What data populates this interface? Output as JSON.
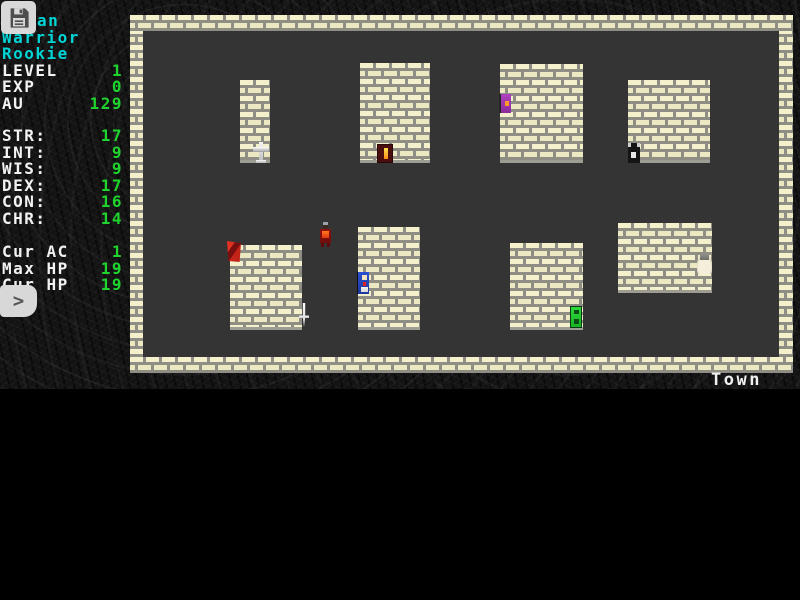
{
  "hud": {
    "save_button_icon": "floppy-disk-icon",
    "prompt_glyph": ">",
    "character": {
      "name_visible": "an",
      "class": "Warrior",
      "rank": "Rookie",
      "level_label": "LEVEL",
      "level": "1",
      "exp_label": "EXP",
      "exp": "0",
      "gold_label": "AU",
      "gold": "129"
    },
    "attributes": [
      {
        "label": "STR:",
        "value": "17"
      },
      {
        "label": "INT:",
        "value": "9"
      },
      {
        "label": "WIS:",
        "value": "9"
      },
      {
        "label": "DEX:",
        "value": "17"
      },
      {
        "label": "CON:",
        "value": "16"
      },
      {
        "label": "CHR:",
        "value": "14"
      }
    ],
    "vitals": [
      {
        "label": "Cur AC",
        "value": "1"
      },
      {
        "label": "Max HP",
        "value": "19"
      },
      {
        "label": "Cur HP",
        "value": "19"
      }
    ],
    "colors": {
      "name_cyan": "#00d4d4",
      "value_green": "#1ed42d",
      "label_white": "#f2f2f2",
      "brick_face": "#f4f0cc",
      "brick_mortar": "#8e8e84",
      "floor_gray": "#343434"
    }
  },
  "map": {
    "location_label": "Town",
    "buildings": [
      {
        "x": 110,
        "y": 65,
        "w": 30,
        "h": 83
      },
      {
        "x": 230,
        "y": 48,
        "w": 70,
        "h": 100
      },
      {
        "x": 370,
        "y": 49,
        "w": 83,
        "h": 99
      },
      {
        "x": 498,
        "y": 65,
        "w": 82,
        "h": 83
      },
      {
        "x": 100,
        "y": 230,
        "w": 72,
        "h": 85
      },
      {
        "x": 228,
        "y": 212,
        "w": 62,
        "h": 103
      },
      {
        "x": 380,
        "y": 228,
        "w": 73,
        "h": 87
      },
      {
        "x": 488,
        "y": 208,
        "w": 94,
        "h": 70
      }
    ],
    "sprites": [
      {
        "type": "cross",
        "x": 123,
        "y": 127,
        "w": 16,
        "h": 21
      },
      {
        "type": "torch-door",
        "x": 247,
        "y": 129,
        "w": 16,
        "h": 19
      },
      {
        "type": "purple-figure",
        "x": 369,
        "y": 79,
        "w": 12,
        "h": 19
      },
      {
        "type": "black-door",
        "x": 498,
        "y": 128,
        "w": 12,
        "h": 20
      },
      {
        "type": "red-banner",
        "x": 97,
        "y": 226,
        "w": 14,
        "h": 21
      },
      {
        "type": "dagger",
        "x": 169,
        "y": 288,
        "w": 10,
        "h": 24
      },
      {
        "type": "red-warrior",
        "x": 188,
        "y": 207,
        "w": 15,
        "h": 25
      },
      {
        "type": "blue-knight",
        "x": 227,
        "y": 257,
        "w": 12,
        "h": 22
      },
      {
        "type": "green-door",
        "x": 440,
        "y": 291,
        "w": 12,
        "h": 22
      },
      {
        "type": "white-hand",
        "x": 567,
        "y": 240,
        "w": 15,
        "h": 19
      }
    ]
  }
}
